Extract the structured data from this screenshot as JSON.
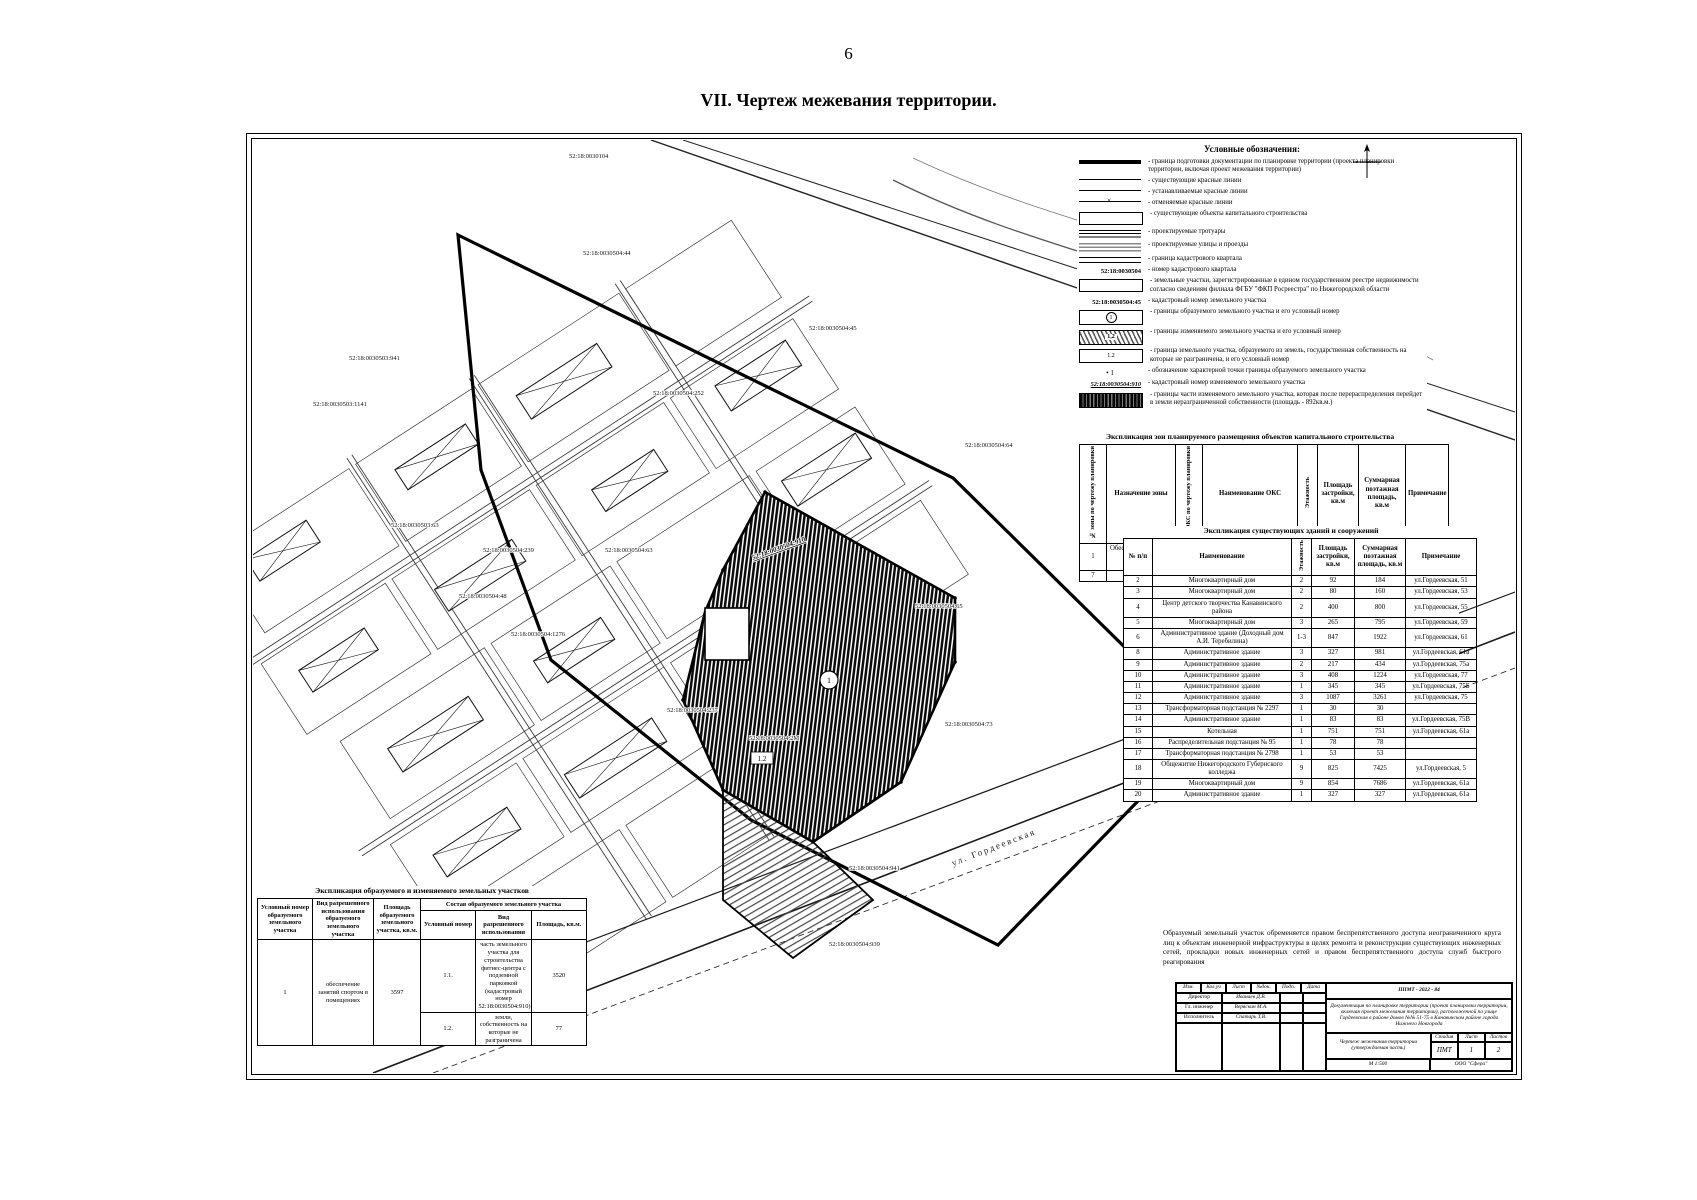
{
  "page": {
    "number": "6",
    "heading": "VII.   Чертеж межевания территории."
  },
  "legend": {
    "title": "Условные обозначения:",
    "items": [
      {
        "sym": "sym-thick",
        "icon": "boundary-thick-line-icon",
        "label": "граница подготовки документации по планировке территории (проекта планировки территории, включая проект межевания территории)"
      },
      {
        "sym": "sym-line",
        "icon": "existing-red-line-icon",
        "label": "существующие красные линии"
      },
      {
        "sym": "sym-line",
        "icon": "established-red-line-icon",
        "label": "устанавливаемые красные линии"
      },
      {
        "sym": "sym-linex",
        "icon": "cancelled-red-line-icon",
        "label": "отменяемые красные линии"
      },
      {
        "sym": "sym-rect",
        "icon": "capital-object-icon",
        "label": "существующие объекты капитального строительства"
      },
      {
        "sym": "sym-sidewalk",
        "icon": "sidewalk-hatch-icon",
        "label": "проектируемые тротуары"
      },
      {
        "sym": "sym-street",
        "icon": "street-hatch-icon",
        "label": "проектируемые улицы и проезды"
      },
      {
        "sym": "sym-dbl",
        "icon": "cadastral-quarter-line-icon",
        "label": "граница кадастрового квартала"
      },
      {
        "sym": "sym-text",
        "icon": "cadastral-quarter-number",
        "sym_text": "52:18:0030504",
        "label": "номер кадастрового квартала"
      },
      {
        "sym": "sym-rect-thin",
        "icon": "registered-parcel-icon",
        "label": "земельные участки, зарегистрированные в едином государственном реестре недвижимости согласно сведениям филиала ФГБУ \"ФКП Росреестра\" по Нижегородской области"
      },
      {
        "sym": "sym-text",
        "icon": "parcel-cadastral-number",
        "sym_text": "52:18:0030504:45",
        "label": "кадастровый номер земельного участка"
      },
      {
        "sym": "sym-circle1",
        "icon": "formed-parcel-icon",
        "inner": "1",
        "label": "границы образуемого земельного участка и его условный номер"
      },
      {
        "sym": "sym-hatch12",
        "icon": "changed-parcel-icon",
        "inner": "1,2",
        "label": "границы изменяемого земельного участка и его условный номер"
      },
      {
        "sym": "sym-rect12",
        "icon": "unbounded-parcel-icon",
        "inner": "1.2",
        "label": "граница земельного участка, образуемого из земель, государственная собственность на которые не разграничена, и его условный номер"
      },
      {
        "sym": "sym-dot",
        "icon": "characteristic-point-icon",
        "sym_text": "•  1",
        "label": "обозначение характерной точки границы образуемого земельного участка"
      },
      {
        "sym": "sym-text-u",
        "icon": "changed-parcel-cadastral-number",
        "sym_text": "52:18:0030504:910",
        "label": "кадастровый номер изменяемого земельного участка"
      },
      {
        "sym": "sym-darkhatch",
        "icon": "redistribution-part-icon",
        "label": "границы части изменяемого земельного участка, которая после перераспределения перейдет в земли неразграниченной собственности (площадь - 892кв.м.)"
      }
    ]
  },
  "table_zones": {
    "title": "Экспликация зон планируемого размещения объектов капитального строительства",
    "columns": [
      "№ зоны по чертежу планировки",
      "Назначение зоны",
      "№ ОКС по чертежу планировки",
      "Наименование ОКС",
      "Этажность",
      "Площадь застройки, кв.м",
      "Суммарная поэтажная площадь, кв.м",
      "Примечание"
    ],
    "rows": [
      [
        "1",
        "Обеспечение занятий спортом в помещениях",
        "1.1.",
        "Физкультурно-оздоровительный комплекс",
        "2",
        "750",
        "1500",
        ""
      ],
      [
        "7",
        "Магазины",
        "7.1.",
        "Магазин",
        "1",
        "95",
        "95",
        "Реконструируемый"
      ]
    ]
  },
  "table_buildings": {
    "title": "Экспликация существующих зданий и сооружений",
    "columns": [
      "№ п/п",
      "Наименование",
      "Этажность",
      "Площадь застройки, кв.м",
      "Суммарная поэтажная площадь, кв.м",
      "Примечание"
    ],
    "rows": [
      [
        "2",
        "Многоквартирный дом",
        "2",
        "92",
        "184",
        "ул.Гордеевская, 51"
      ],
      [
        "3",
        "Многоквартирный дом",
        "2",
        "80",
        "160",
        "ул.Гордеевская, 53"
      ],
      [
        "4",
        "Центр детского творчества Канавинского района",
        "2",
        "400",
        "800",
        "ул.Гордеевская, 55"
      ],
      [
        "5",
        "Многоквартирный дом",
        "3",
        "265",
        "795",
        "ул.Гордеевская, 59"
      ],
      [
        "6",
        "Административное здание (Доходный дом А.И. Теребилина)",
        "1-3",
        "847",
        "1922",
        "ул.Гордеевская, 61"
      ],
      [
        "8",
        "Административное здание",
        "3",
        "327",
        "981",
        "ул.Гордеевская, 61а"
      ],
      [
        "9",
        "Административное здание",
        "2",
        "217",
        "434",
        "ул.Гордеевская, 75а"
      ],
      [
        "10",
        "Административное здание",
        "3",
        "408",
        "1224",
        "ул.Гордеевская, 77"
      ],
      [
        "11",
        "Административное здание",
        "1",
        "345",
        "345",
        "ул.Гордеевская, 75Б"
      ],
      [
        "12",
        "Административное здание",
        "3",
        "1087",
        "3261",
        "ул.Гордеевская, 75"
      ],
      [
        "13",
        "Трансформаторная подстанция № 2297",
        "1",
        "30",
        "30",
        ""
      ],
      [
        "14",
        "Административное здание",
        "1",
        "83",
        "83",
        "ул.Гордеевская, 75В"
      ],
      [
        "15",
        "Котельная",
        "1",
        "751",
        "751",
        "ул.Гордеевская, 61а"
      ],
      [
        "16",
        "Распределительная подстанция № 95",
        "1",
        "78",
        "78",
        ""
      ],
      [
        "17",
        "Трансформаторная подстанция № 2798",
        "1",
        "53",
        "53",
        ""
      ],
      [
        "18",
        "Общежитие Нижегородского Губернского колледжа",
        "9",
        "825",
        "7425",
        "ул.Гордеевская, 5"
      ],
      [
        "19",
        "Многоквартирный дом",
        "9",
        "854",
        "7686",
        "ул.Гордеевская, 61а"
      ],
      [
        "20",
        "Административное здание",
        "1",
        "327",
        "327",
        "ул.Гордеевская, 61а"
      ]
    ]
  },
  "note": {
    "text": "Образуемый земельный участок обременяется правом беспрепятственного доступа неограниченного круга лиц к объектам инженерной инфраструктуры в целях ремонта и реконструкции существующих инженерных сетей, прокладки новых инженерных сетей и правом беспрепятственного доступа служб быстрого реагирования"
  },
  "table_parcels": {
    "title": "Экспликация образуемого и изменяемого земельных участков",
    "col_num": "Условный номер образуемого земельного участка",
    "col_use": "Вид разрешенного использования образуемого земельного участка",
    "col_area": "Площадь образуемого земельного участка, кв.м.",
    "col_group": "Состав образуемого земельного участка",
    "sub_num": "Условный номер",
    "sub_use": "Вид разрешенного использования",
    "sub_area": "Площадь, кв.м.",
    "row": {
      "num": "1",
      "use": "обеспечение занятий спортом в помещениях",
      "area": "3597",
      "subs": [
        {
          "num": "1.1.",
          "use": "часть земельного участка для строительства фитнес-центра с подземной парковкой (кадастровый номер 52:18:0030504:910)",
          "area": "3520"
        },
        {
          "num": "1.2.",
          "use": "земли, собственность на которые не разграничена",
          "area": "77"
        }
      ]
    }
  },
  "stamp": {
    "code": "ППМТ - 2022 - 84",
    "desc": "Документация по планировке территории (проект планировки территории, включая проект межевания территории), расположенной по улице Гордеевская в районе домов №№ 51-75 в Канавинском районе города Нижнего Новгорода",
    "cols": [
      "Изм.",
      "Кол.уч",
      "Лист",
      "№док.",
      "Подп.",
      "Дата"
    ],
    "roles": [
      {
        "role": "Директор",
        "name": "Иванаев Д.В."
      },
      {
        "role": "Гл. инженер",
        "name": "Веряскин М.А."
      },
      {
        "role": "Исполнитель",
        "name": "Спатарь Т.В."
      }
    ],
    "doc_title": "Чертеж межевания территории (утверждаемая часть)",
    "stage_label": "Стадия",
    "sheet_label": "Лист",
    "sheets_label": "Листов",
    "stage": "ПМТ",
    "sheet": "1",
    "sheets": "2",
    "scale": "М 1:500",
    "company": "ООО \"Сфера\""
  },
  "map": {
    "labels": [
      {
        "t": "52:18:0030104",
        "x": 316,
        "y": 18,
        "r": 0
      },
      {
        "t": "52:18:0030504:44",
        "x": 330,
        "y": 115,
        "r": 0
      },
      {
        "t": "52:18:0030503:941",
        "x": 96,
        "y": 220,
        "r": 0
      },
      {
        "t": "52:18:0030503:1141",
        "x": 60,
        "y": 266,
        "r": 0
      },
      {
        "t": "52:18:0030504:252",
        "x": 400,
        "y": 255,
        "r": 0
      },
      {
        "t": "52:18:0030504:45",
        "x": 556,
        "y": 190,
        "r": 0
      },
      {
        "t": "52:18:0030504:64",
        "x": 712,
        "y": 307,
        "r": 0
      },
      {
        "t": "52:18:0030503:63",
        "x": 138,
        "y": 387,
        "r": 0
      },
      {
        "t": "52:18:0030504:239",
        "x": 230,
        "y": 412,
        "r": 0
      },
      {
        "t": "52:18:0030504:63",
        "x": 352,
        "y": 412,
        "r": 0
      },
      {
        "t": "52:18:0030504:48",
        "x": 206,
        "y": 458,
        "r": 0
      },
      {
        "t": "52:18:0030504:1276",
        "x": 258,
        "y": 496,
        "r": 0
      },
      {
        "t": "52:18:0030504:65",
        "x": 662,
        "y": 468,
        "r": 0
      },
      {
        "t": "52:18:0030504:73",
        "x": 692,
        "y": 586,
        "r": 0
      },
      {
        "t": "52:18:0030504:237",
        "x": 414,
        "y": 572,
        "r": 0
      },
      {
        "t": "52:18:0030504:2М",
        "x": 496,
        "y": 600,
        "r": 0
      },
      {
        "t": "52:18:0030504:941",
        "x": 596,
        "y": 730,
        "r": 0
      },
      {
        "t": "52:18:0030504:939",
        "x": 576,
        "y": 806,
        "r": 0
      }
    ],
    "changed_parcel_number": "52:18:0030504:910",
    "street_label": "ул. Гордеевская",
    "formed_parcel_number": "1",
    "unbounded_parcel_number": "1.2"
  }
}
